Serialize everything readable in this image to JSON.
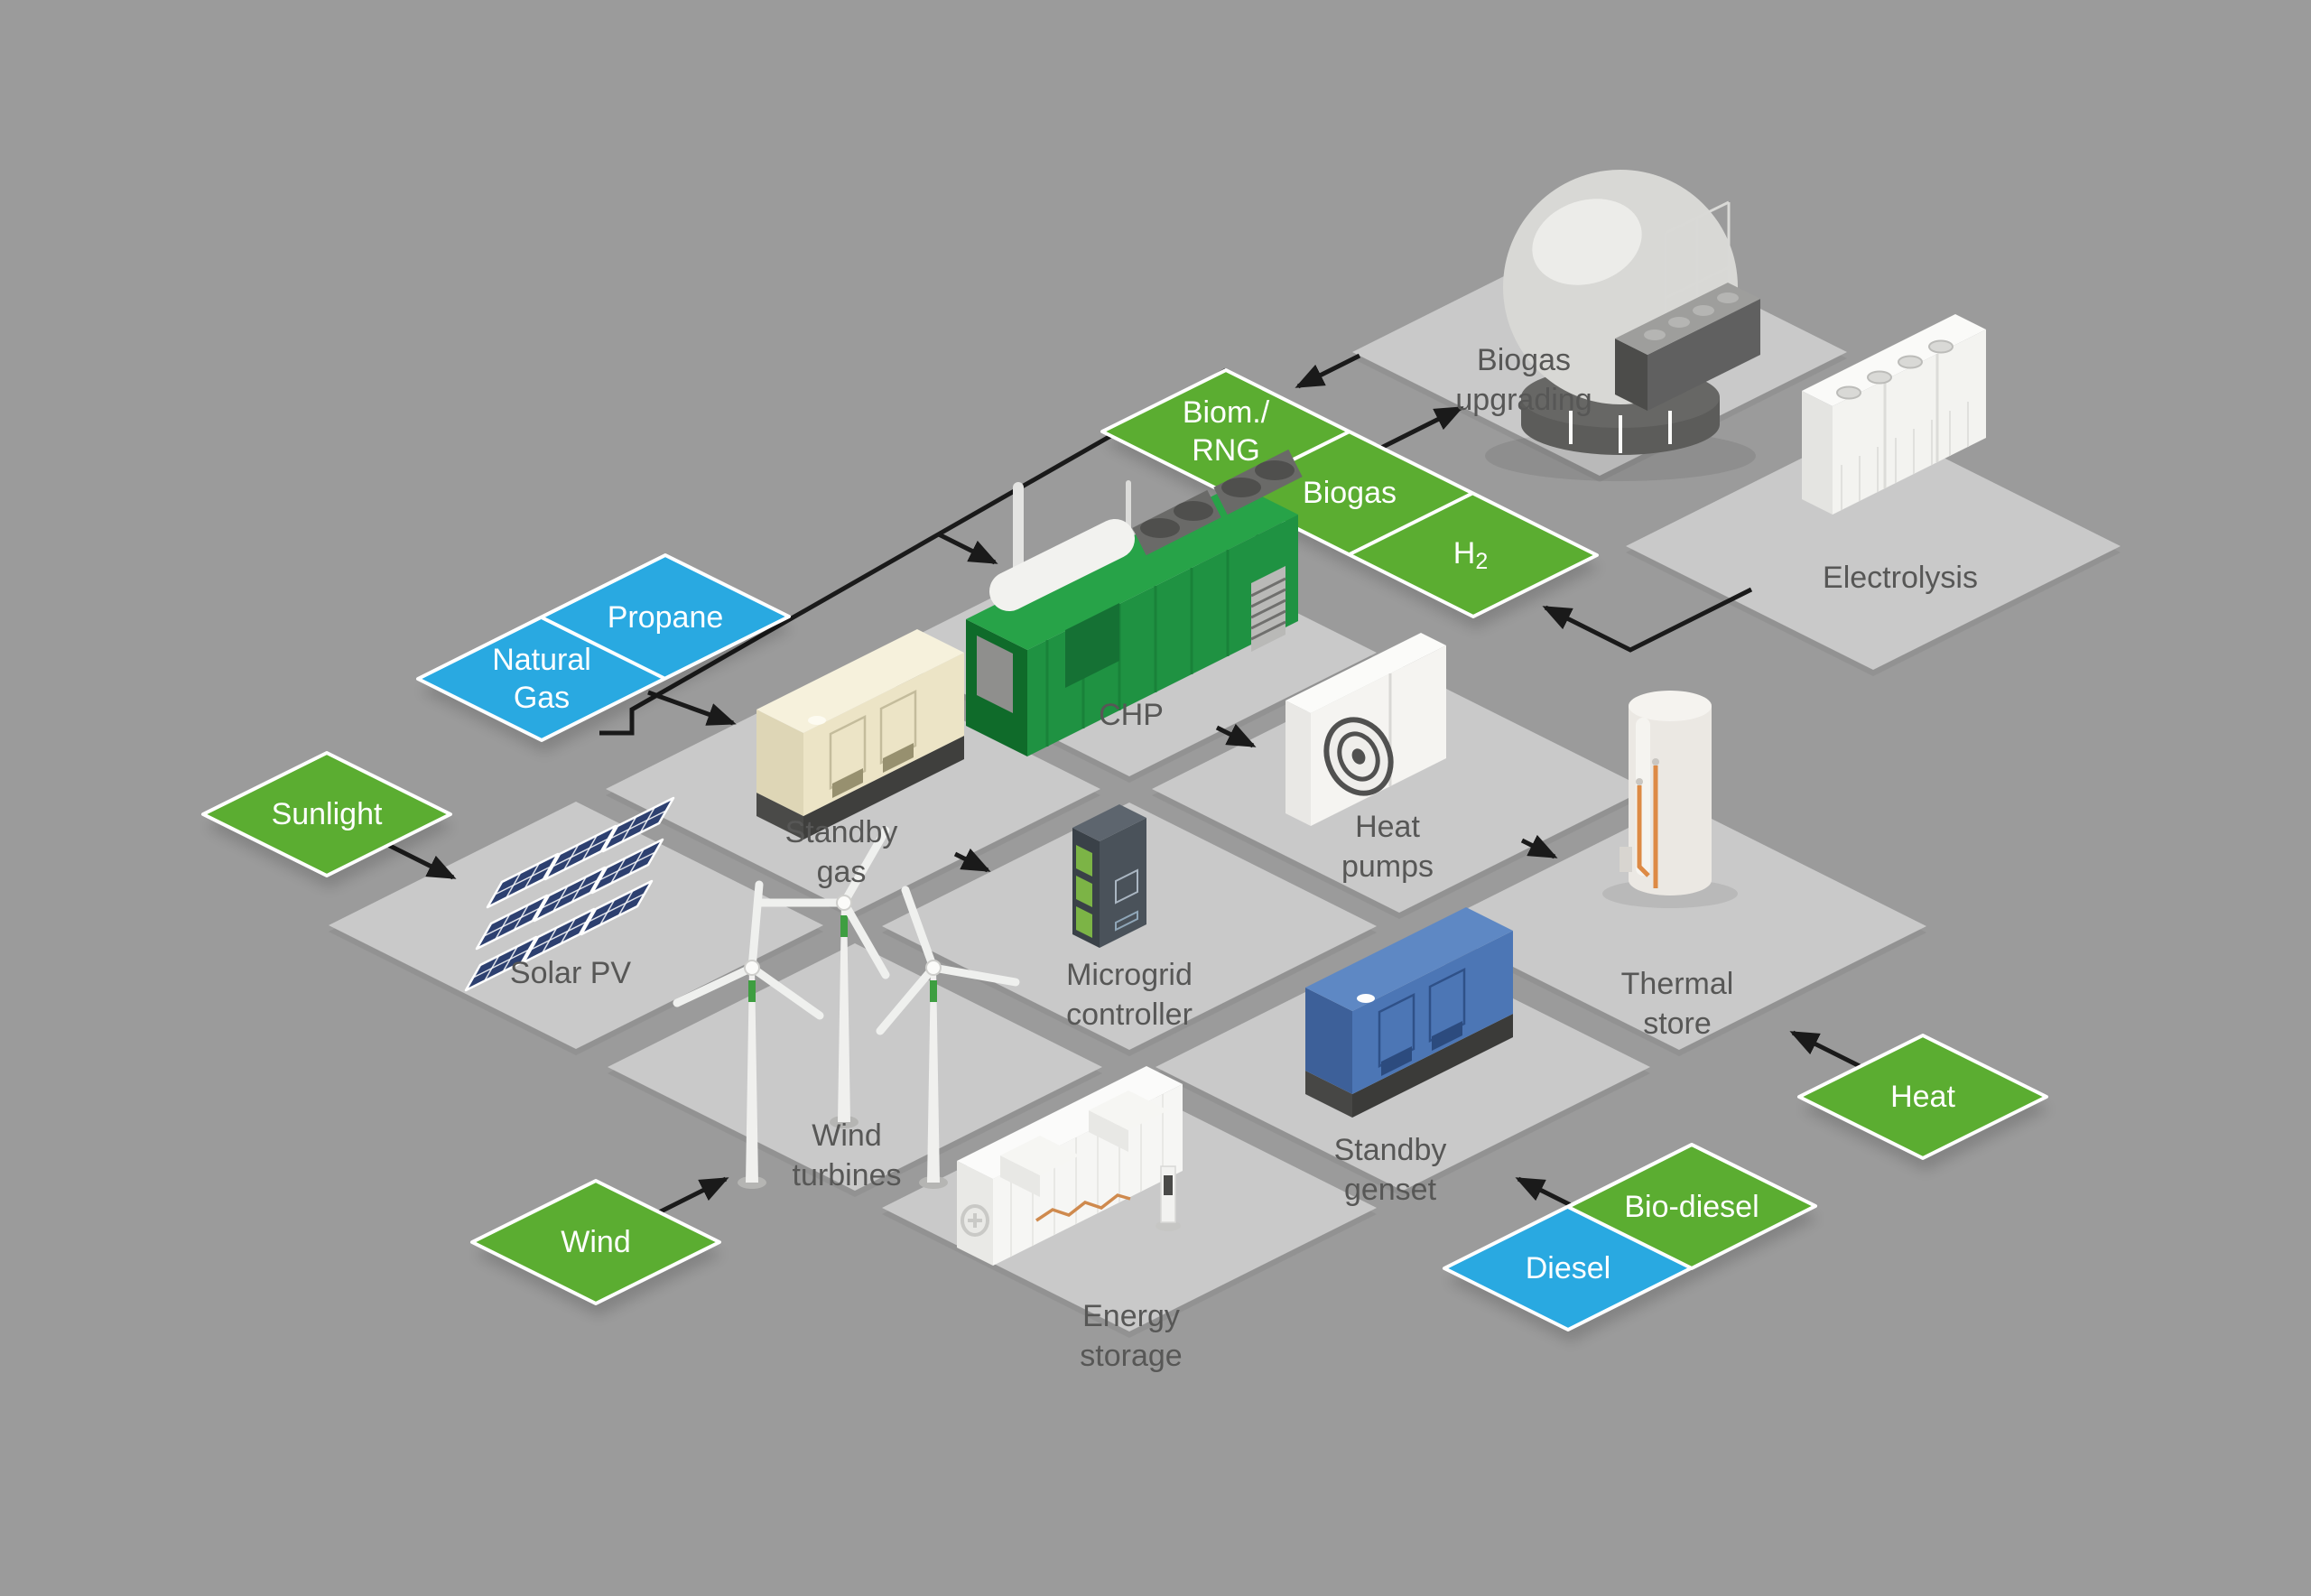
{
  "colors": {
    "background": "#9B9B9B",
    "tile": "#C9C9C9",
    "renewable_green": "#5BAD31",
    "fossil_blue": "#29A9E1",
    "label_text": "#575756",
    "diamond_text": "#FFFFFF",
    "diamond_border": "#FFFFFF",
    "arrow": "#1A1A1A"
  },
  "facilities": {
    "biogas_upgrading": {
      "line1": "Biogas",
      "line2": "upgrading"
    },
    "electrolysis": {
      "line1": "Electrolysis"
    },
    "chp": {
      "line1": "CHP"
    },
    "standby_gas": {
      "line1": "Standby",
      "line2": "gas"
    },
    "heat_pumps": {
      "line1": "Heat",
      "line2": "pumps"
    },
    "solar_pv": {
      "line1": "Solar PV"
    },
    "microgrid_controller": {
      "line1": "Microgrid",
      "line2": "controller"
    },
    "thermal_store": {
      "line1": "Thermal",
      "line2": "store"
    },
    "wind_turbines": {
      "line1": "Wind",
      "line2": "turbines"
    },
    "standby_genset": {
      "line1": "Standby",
      "line2": "genset"
    },
    "energy_storage": {
      "line1": "Energy",
      "line2": "storage"
    }
  },
  "inputs": {
    "sunlight": {
      "label": "Sunlight",
      "kind": "renewable"
    },
    "wind": {
      "label": "Wind",
      "kind": "renewable"
    },
    "heat": {
      "label": "Heat",
      "kind": "renewable"
    },
    "natural_gas": {
      "line1": "Natural",
      "line2": "Gas",
      "kind": "fossil"
    },
    "propane": {
      "label": "Propane",
      "kind": "fossil"
    },
    "biom_rng": {
      "line1": "Biom./",
      "line2": "RNG",
      "kind": "renewable"
    },
    "biogas": {
      "label": "Biogas",
      "kind": "renewable"
    },
    "h2": {
      "label": "H",
      "sub": "2",
      "kind": "renewable"
    },
    "diesel": {
      "label": "Diesel",
      "kind": "fossil"
    },
    "bio_diesel": {
      "label": "Bio-diesel",
      "kind": "renewable"
    }
  },
  "flows": [
    {
      "from": "biogas",
      "to": "biogas_upgrading"
    },
    {
      "from": "biogas_upgrading",
      "to": "biom_rng"
    },
    {
      "from": "electrolysis",
      "to": "h2"
    },
    {
      "from": "biom_rng_biogas_h2",
      "to": "chp"
    },
    {
      "from": "natural_gas_propane",
      "to": "chp"
    },
    {
      "from": "natural_gas_propane",
      "to": "standby_gas"
    },
    {
      "from": "chp",
      "to": "heat_pumps"
    },
    {
      "from": "sunlight",
      "to": "solar_pv"
    },
    {
      "from": "standby_gas",
      "to": "microgrid_controller"
    },
    {
      "from": "heat_pumps",
      "to": "thermal_store"
    },
    {
      "from": "wind",
      "to": "wind_turbines"
    },
    {
      "from": "heat",
      "to": "thermal_store"
    },
    {
      "from": "diesel_bio_diesel",
      "to": "standby_genset"
    }
  ]
}
